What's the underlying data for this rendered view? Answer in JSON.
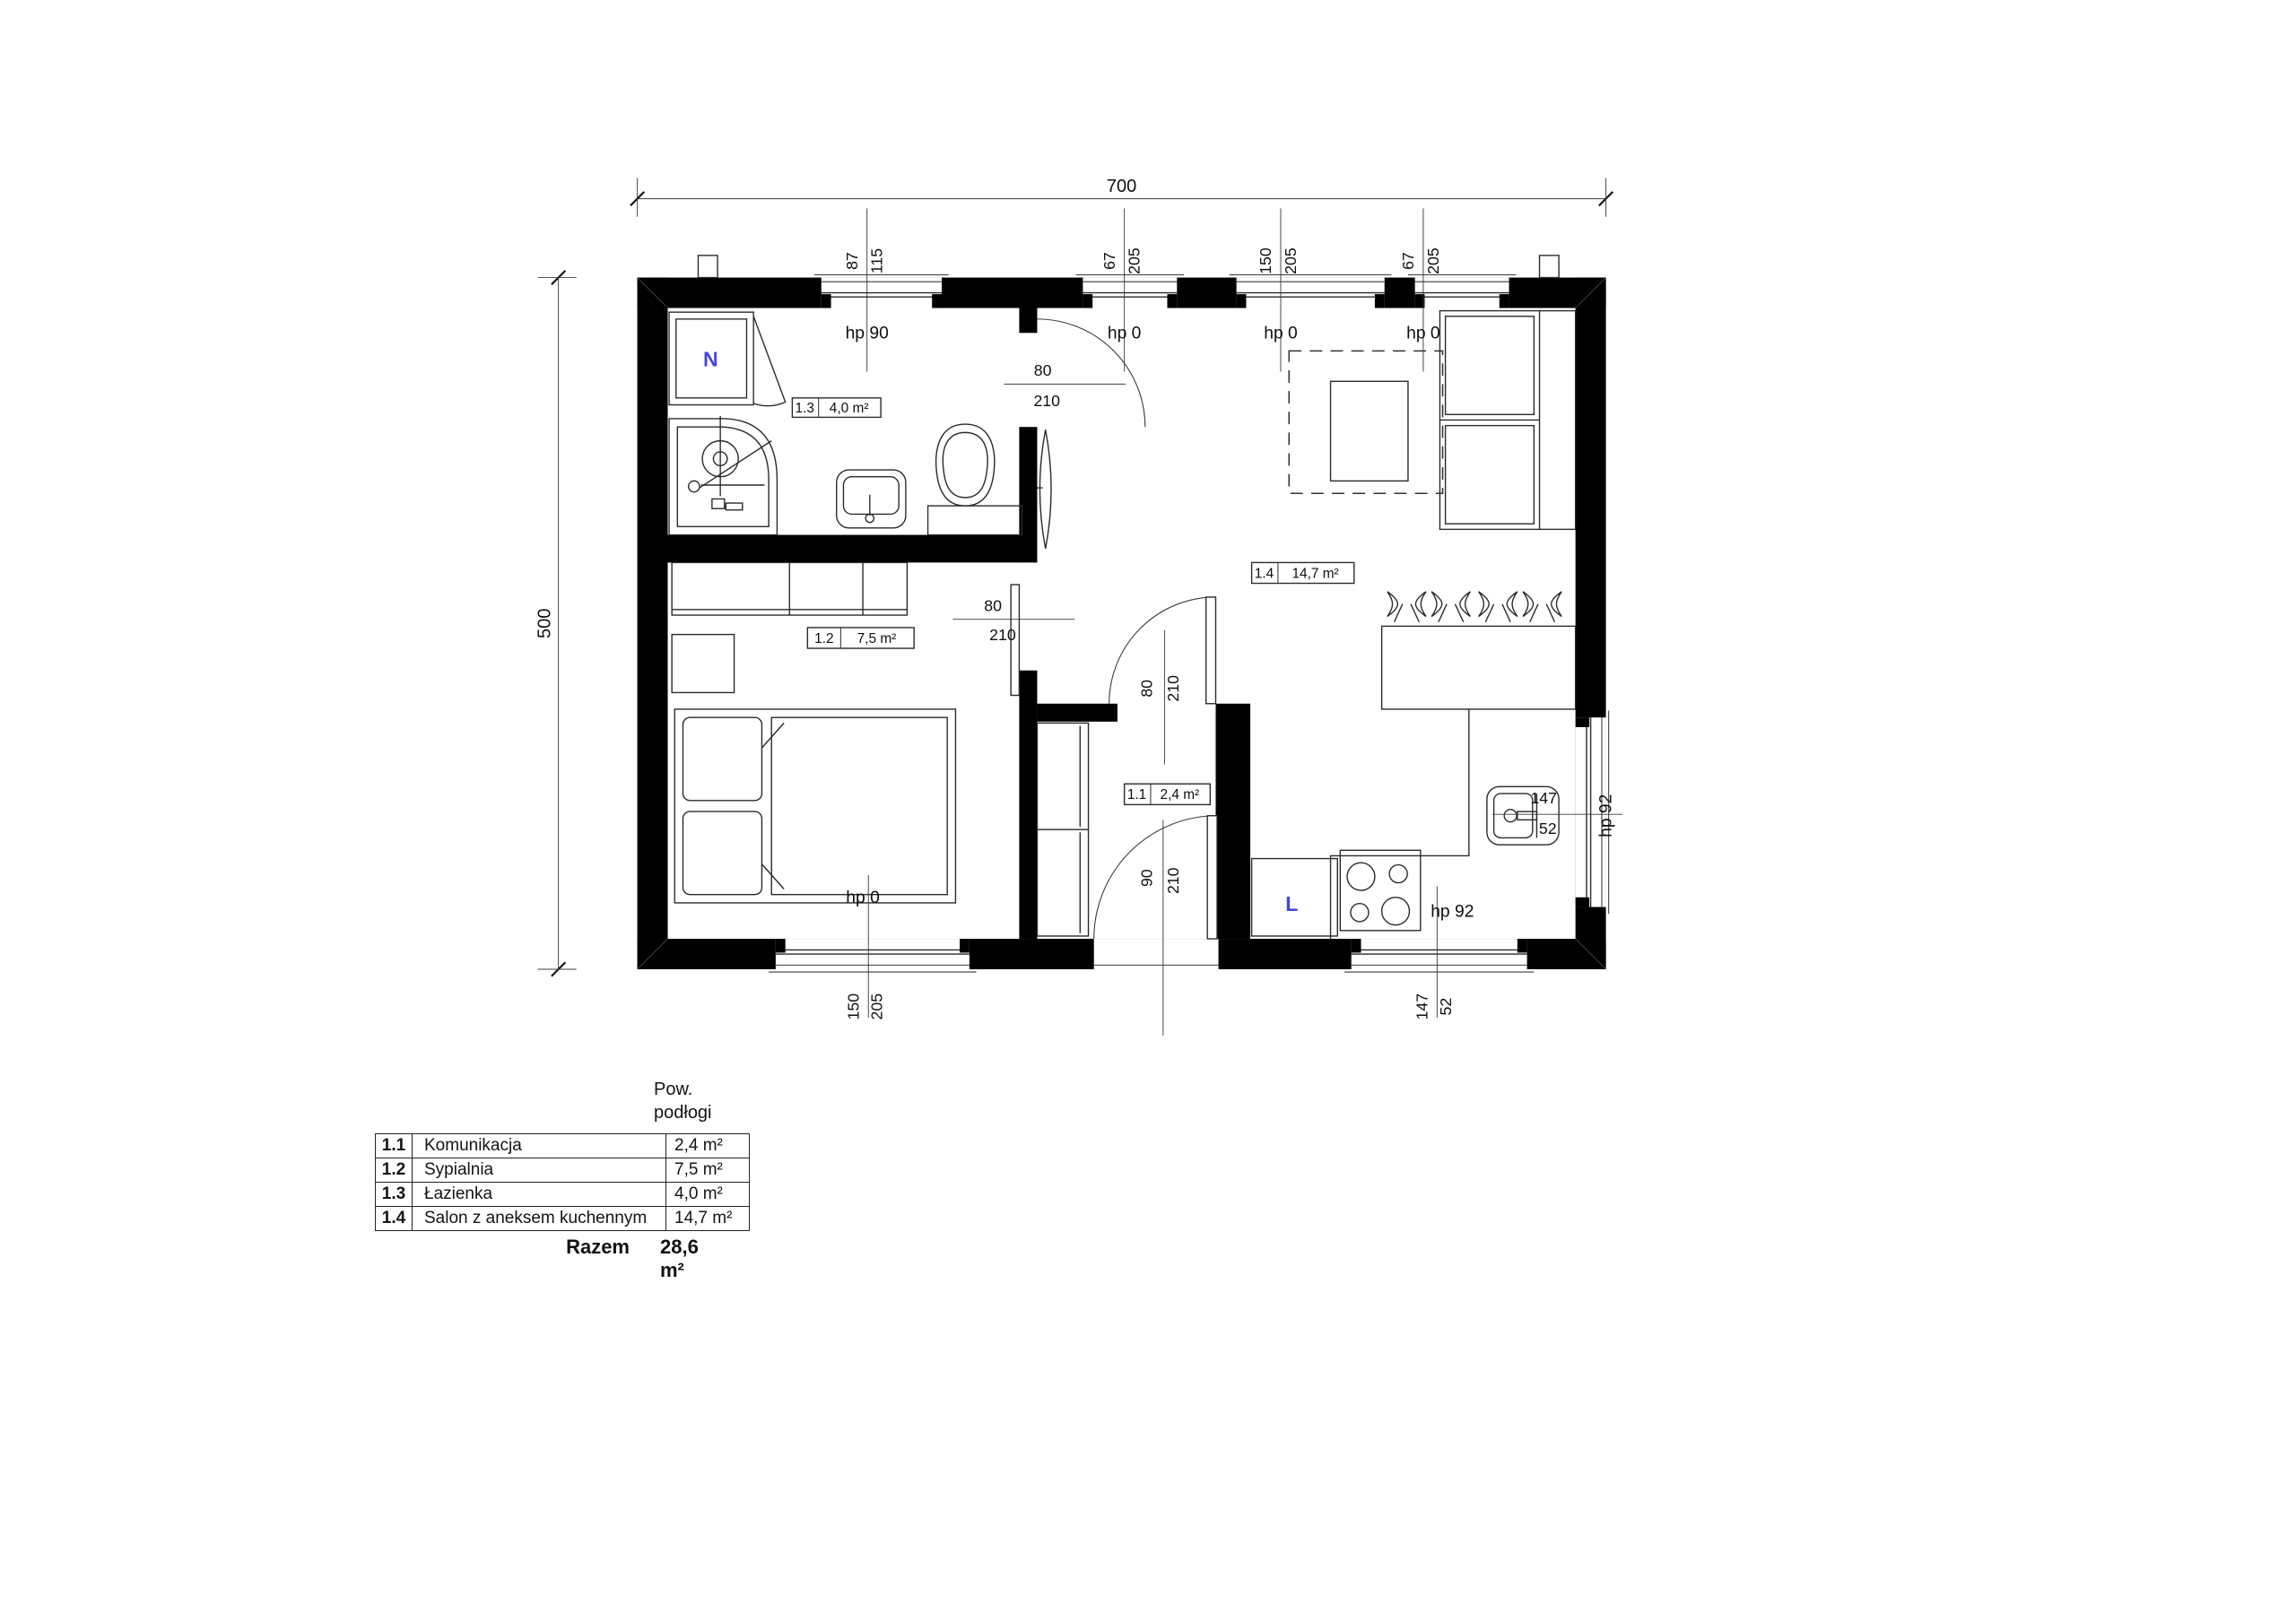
{
  "plan": {
    "total_width": "700",
    "total_height": "500",
    "windows": {
      "top": [
        {
          "size": "87",
          "height": "115",
          "hp": "hp 90"
        },
        {
          "size": "67",
          "height": "205",
          "hp": "hp 0"
        },
        {
          "size": "150",
          "height": "205",
          "hp": "hp 0"
        },
        {
          "size": "67",
          "height": "205",
          "hp": "hp 0"
        }
      ],
      "bottom_bedroom": {
        "size": "150",
        "height": "205",
        "hp": "hp 0"
      },
      "bottom_kitchen": {
        "size": "147",
        "height": "52",
        "hp": "hp 92"
      },
      "right": {
        "size": "147",
        "height": "52",
        "hp": "hp 92"
      }
    },
    "doors": {
      "bathroom": {
        "w": "80",
        "h": "210"
      },
      "bedroom": {
        "w": "80",
        "h": "210"
      },
      "hall": {
        "w": "80",
        "h": "210"
      },
      "entrance": {
        "w": "90",
        "h": "210"
      }
    },
    "rooms": [
      {
        "num": "1.1",
        "name": "Komunikacja",
        "area": "2,4 m²"
      },
      {
        "num": "1.2",
        "name": "Sypialnia",
        "area": "7,5 m²"
      },
      {
        "num": "1.3",
        "name": "Łazienka",
        "area": "4,0 m²"
      },
      {
        "num": "1.4",
        "name": "Salon z aneksem kuchennym",
        "area": "14,7 m²"
      }
    ],
    "appliances": {
      "washer": "N",
      "fridge": "L"
    }
  },
  "table": {
    "header_line1": "Pow.",
    "header_line2": "podłogi",
    "total_label": "Razem",
    "total_value": "28,6 m²"
  },
  "colors": {
    "accent_blue": "#4545dd",
    "wall": "#000000"
  }
}
